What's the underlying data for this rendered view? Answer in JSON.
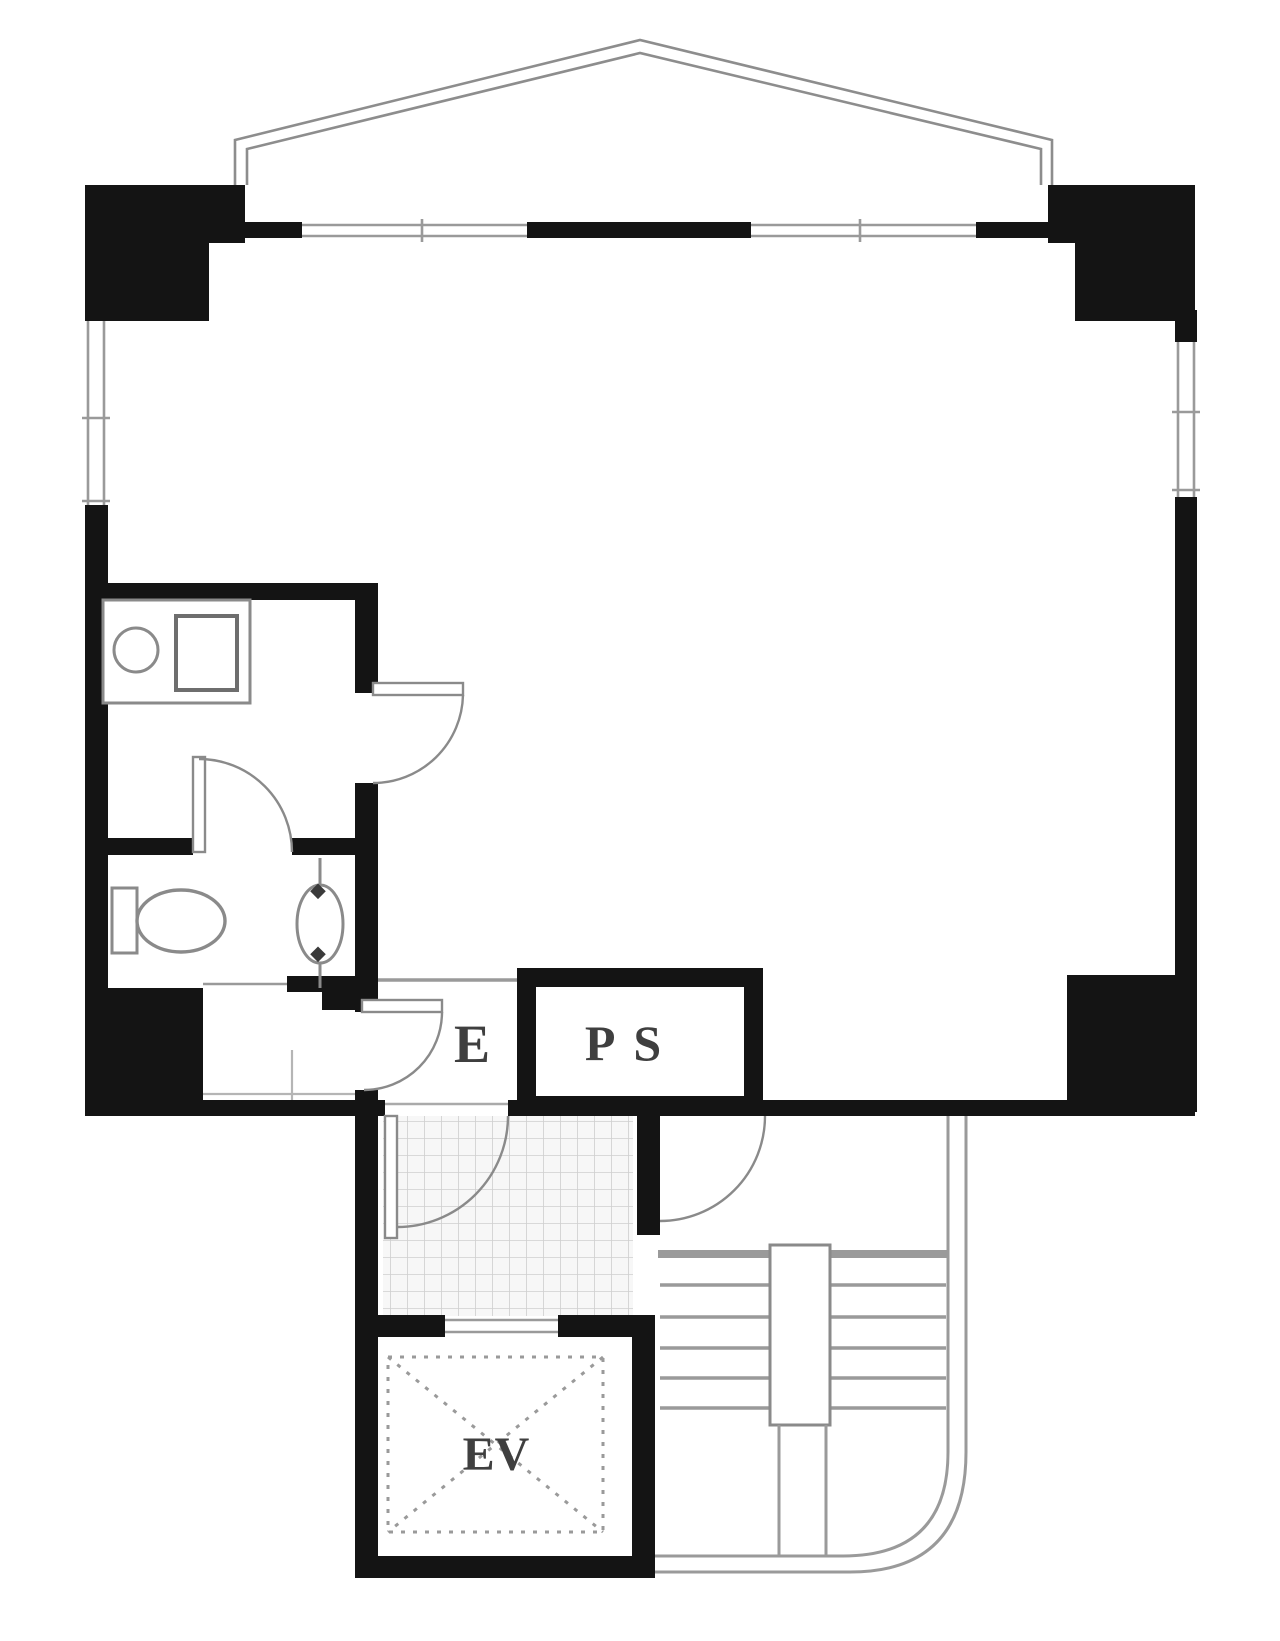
{
  "document": {
    "kind": "architectural floor plan",
    "orientation": "single residential/office unit with common stair and elevator core at bottom"
  },
  "labels": {
    "entrance": "E",
    "pipe_shaft": "PS",
    "elevator": "EV"
  },
  "colors": {
    "wall_black": "#141414",
    "line_gray": "#9a9a9a",
    "fixture_gray": "#8a8a8a",
    "tile_line": "#cfcfcf",
    "tile_fill": "#f7f7f7",
    "label_text": "#3f3f3f",
    "background": "#ffffff"
  }
}
